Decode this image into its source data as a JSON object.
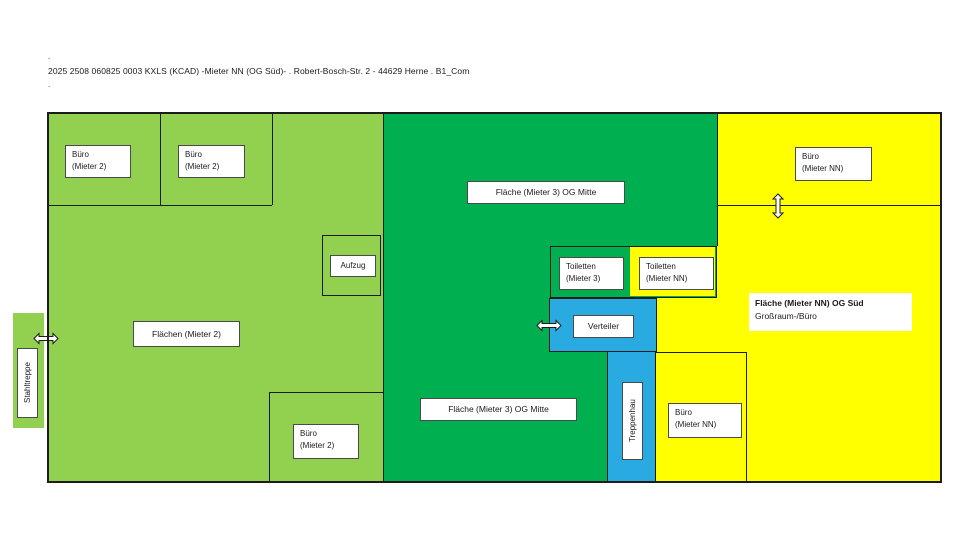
{
  "colors": {
    "light_green": "#92D050",
    "dark_green": "#00B050",
    "yellow": "#FFFF00",
    "blue": "#29ABE2",
    "wall": "#1C1C1C",
    "text": "#1A1A1A"
  },
  "header": {
    "dot_above": ".",
    "title": "2025 2508 060825 0003 KXLS (KCAD) -Mieter NN (OG Süd)- . Robert-Bosch-Str. 2 - 44629 Herne . B1_Com",
    "dot_below": "."
  },
  "icons": {
    "stahltreppe_opening": "double-arrow-horizontal",
    "verteiler_opening": "double-arrow-horizontal",
    "buero_nn_opening": "double-arrow-vertical"
  },
  "labels": {
    "buero_m2_a": {
      "line1": "Büro",
      "line2": "(Mieter 2)"
    },
    "buero_m2_b": {
      "line1": "Büro",
      "line2": "(Mieter 2)"
    },
    "flaeche_m3_top": {
      "line1": "Fläche (Mieter 3) OG Mitte"
    },
    "buero_nn_top": {
      "line1": "Büro",
      "line2": "(Mieter NN)"
    },
    "aufzug": {
      "line1": "Aufzug"
    },
    "toiletten_m3": {
      "line1": "Toiletten",
      "line2": "(Mieter 3)"
    },
    "toiletten_nn": {
      "line1": "Toiletten",
      "line2": "(Mieter NN)"
    },
    "flaechen_m2": {
      "line1": "Flächen (Mieter 2)"
    },
    "verteiler": {
      "line1": "Verteiler"
    },
    "flaeche_nn_sued": {
      "line1": "Fläche (Mieter NN) OG Süd",
      "line2": "Großraum-/Büro"
    },
    "flaeche_m3_bottom": {
      "line1": "Fläche (Mieter 3) OG Mitte"
    },
    "buero_nn_bottom": {
      "line1": "Büro",
      "line2": "(Mieter NN)"
    },
    "buero_m2_bottom": {
      "line1": "Büro",
      "line2": "(Mieter 2)"
    },
    "treppenhaus": {
      "line1": "Treppenhau"
    },
    "stahltreppe": {
      "line1": "Stahltreppe"
    }
  }
}
